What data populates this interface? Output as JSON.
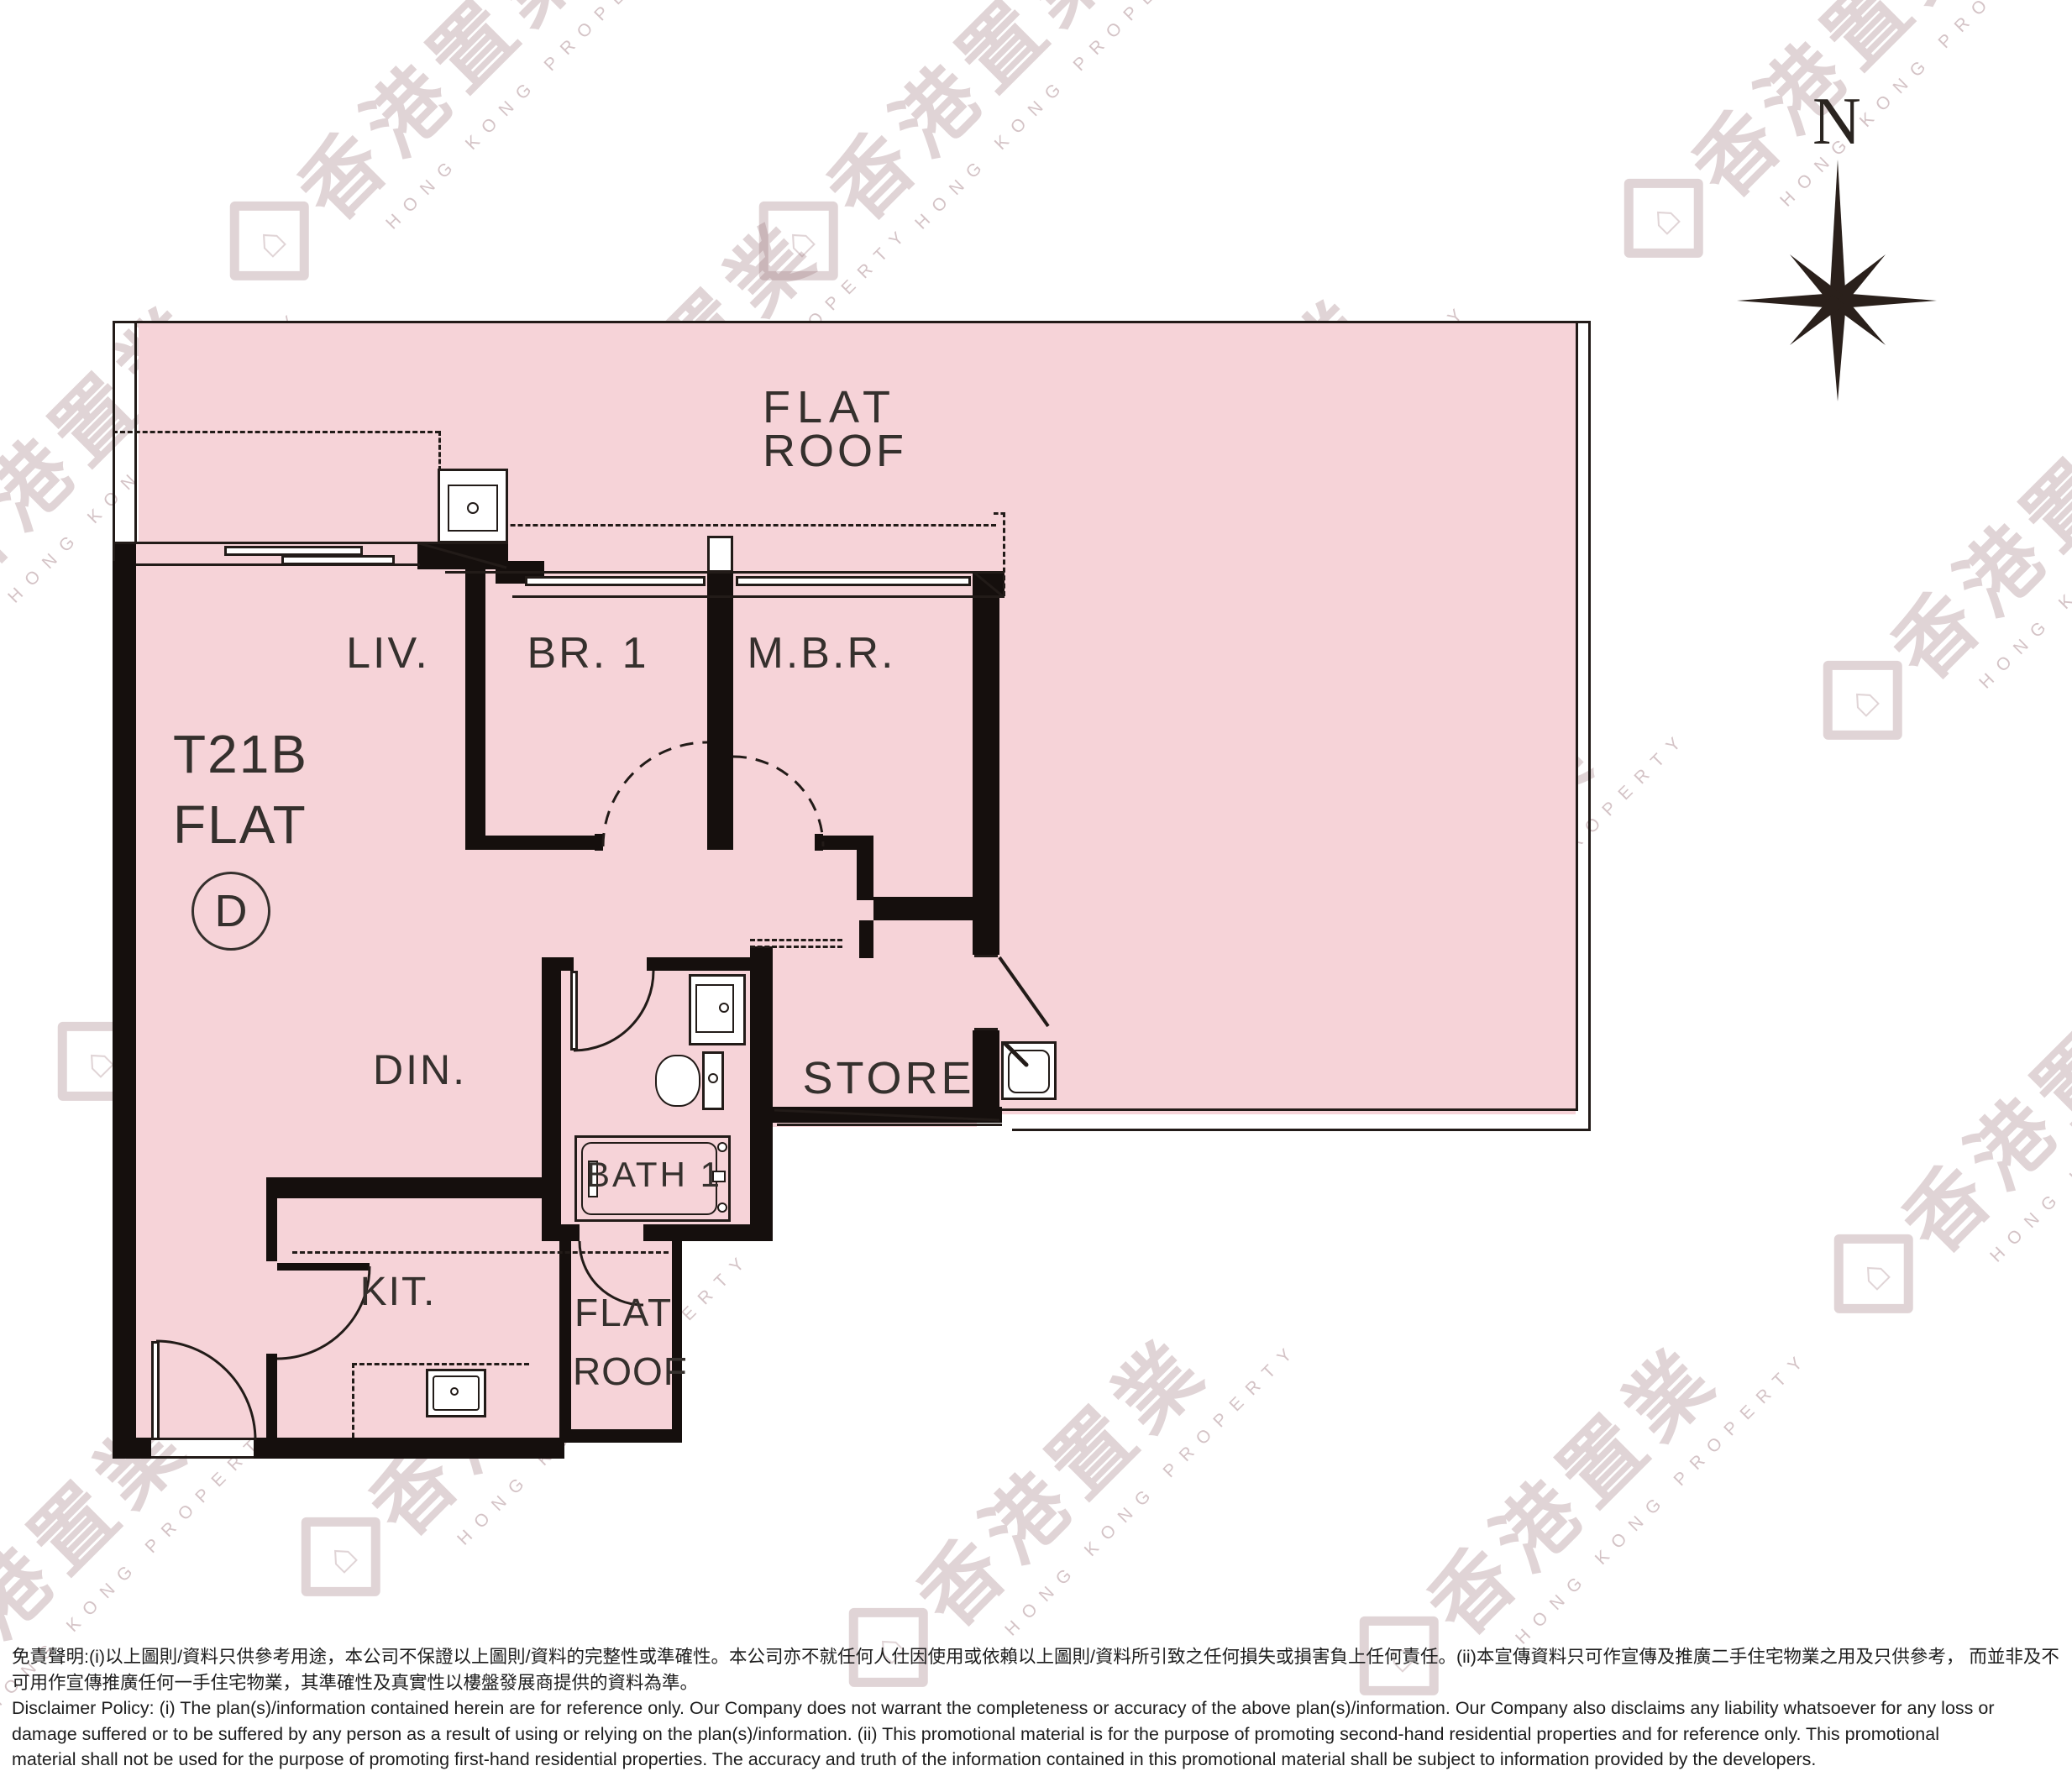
{
  "title": "T21B Flat D floor plan",
  "compass": {
    "north_label": "N"
  },
  "watermark": {
    "cjk": "香港置業",
    "latin": "HONG KONG PROPERTY",
    "house_glyph": "⌂"
  },
  "plan": {
    "unit": {
      "tower": "T21B",
      "flat_word": "FLAT",
      "flat_letter": "D"
    },
    "rooms": {
      "flat_roof_main": {
        "line1": "FLAT",
        "line2": "ROOF"
      },
      "living": "LIV.",
      "bedroom1": "BR. 1",
      "master_bedroom": "M.B.R.",
      "dining": "DIN.",
      "store": "STORE",
      "bath": "BATH 1",
      "kitchen": "KIT.",
      "flat_roof_small": {
        "line1": "FLAT",
        "line2": "ROOF"
      }
    },
    "colors": {
      "fill": "#f6d3d8",
      "wall": "#150f0d",
      "line": "#221b18"
    }
  },
  "disclaimer": {
    "lines": [
      "免責聲明:(i)以上圖則/資料只供參考用途，本公司不保證以上圖則/資料的完整性或準確性。本公司亦不就任何人仕因使用或依賴以上圖則/資料所引致之任何損失或損害負上任何責任。(ii)本宣傳資料只可作宣傳及推廣二手住宅物業之用及只供參考， 而並非及不",
      "可用作宣傳推廣任何一手住宅物業，其準確性及真實性以樓盤發展商提供的資料為準。",
      "Disclaimer Policy: (i) The plan(s)/information contained herein are for reference only. Our Company does not warrant the completeness or accuracy of the above plan(s)/information. Our Company also disclaims any liability whatsoever for any loss or",
      "damage suffered or to be suffered by any person as a result of using or relying on the plan(s)/information. (ii) This promotional material is for the purpose of promoting second-hand residential properties and for reference only. This promotional",
      "material shall not be used for the purpose of promoting first-hand residential properties. The accuracy and truth of the information contained in this promotional material shall be subject to information provided by the developers."
    ]
  }
}
